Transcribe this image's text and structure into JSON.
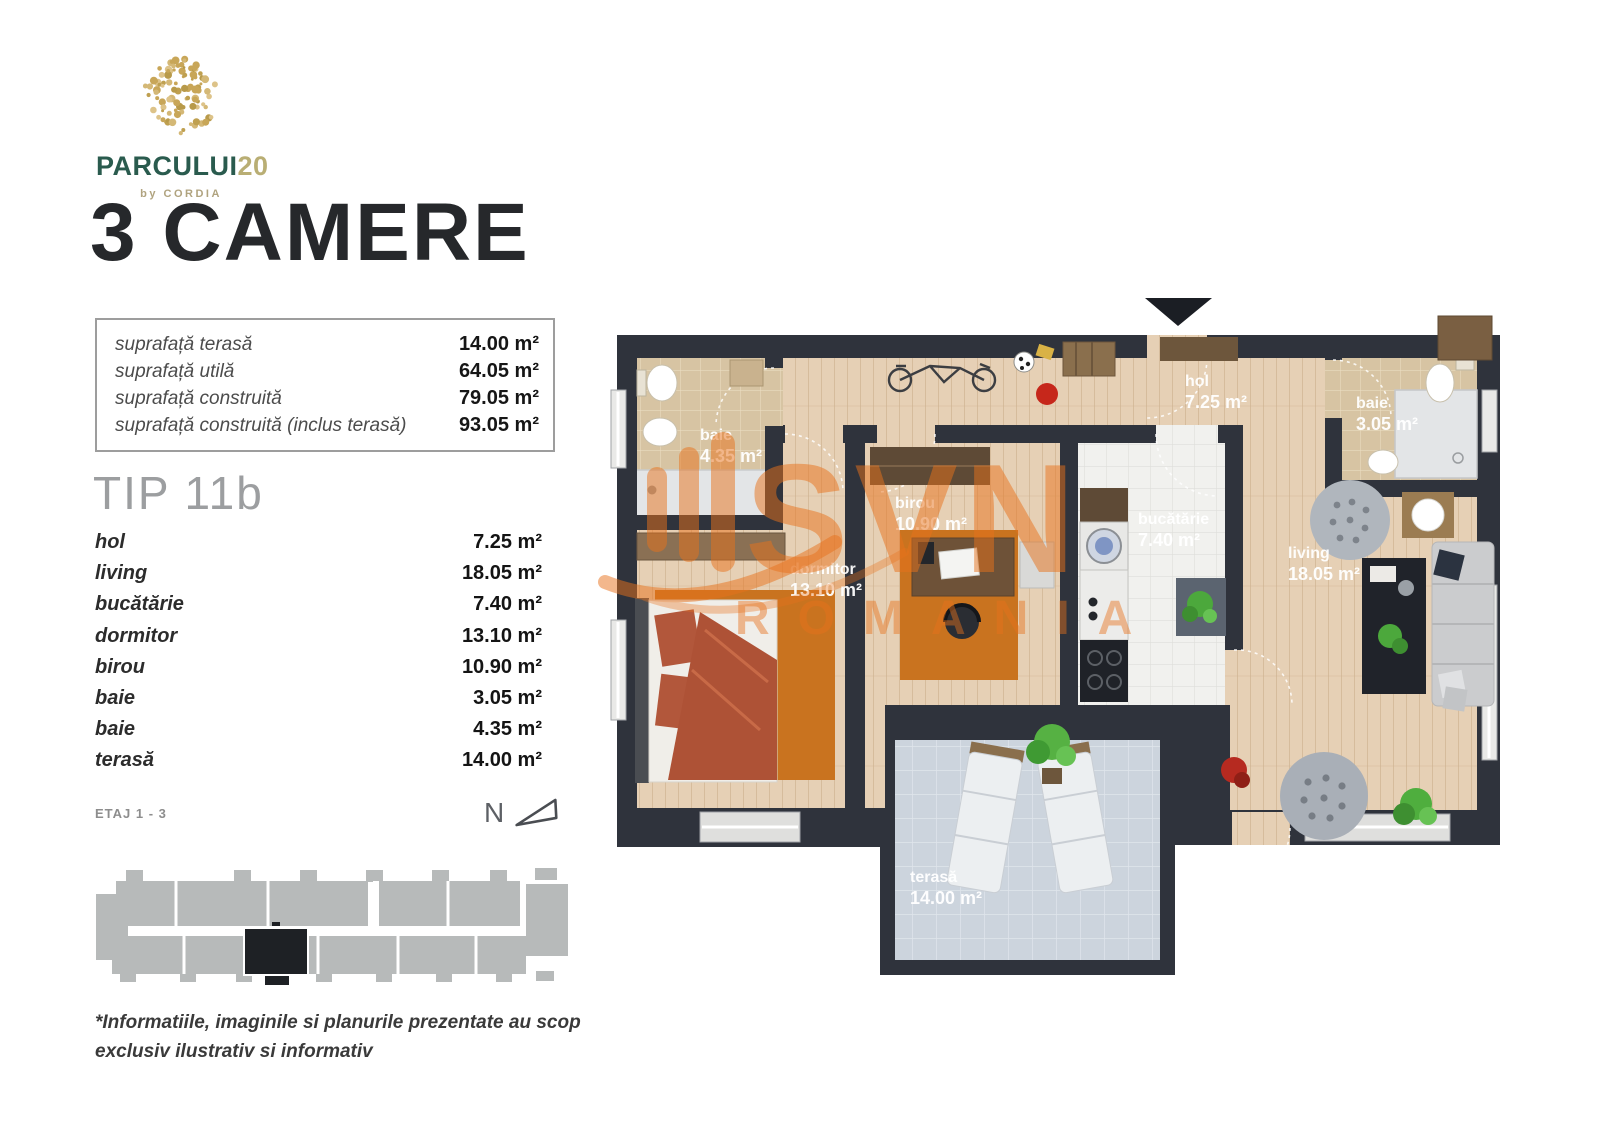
{
  "brand": {
    "name": "PARCULUI",
    "suffix": "20",
    "byline": "by CORDIA"
  },
  "header": {
    "title": "3 CAMERE"
  },
  "summary": {
    "rows": [
      {
        "label": "suprafață terasă",
        "value": "14.00 m²"
      },
      {
        "label": "suprafață utilă",
        "value": "64.05 m²"
      },
      {
        "label": "suprafață construită",
        "value": "79.05 m²"
      },
      {
        "label": "suprafață construită (inclus terasă)",
        "value": "93.05 m²"
      }
    ]
  },
  "unit": {
    "type_label": "TIP 11b",
    "floor_label": "ETAJ 1 - 3",
    "north_label": "N"
  },
  "room_list": [
    {
      "label": "hol",
      "value": "7.25 m²"
    },
    {
      "label": "living",
      "value": "18.05 m²"
    },
    {
      "label": "bucătărie",
      "value": "7.40 m²"
    },
    {
      "label": "dormitor",
      "value": "13.10 m²"
    },
    {
      "label": "birou",
      "value": "10.90 m²"
    },
    {
      "label": "baie",
      "value": "3.05 m²"
    },
    {
      "label": "baie",
      "value": "4.35 m²"
    },
    {
      "label": "terasă",
      "value": "14.00 m²"
    }
  ],
  "floor_plan": {
    "rooms": [
      {
        "name": "baie",
        "area": "4.35 m²"
      },
      {
        "name": "hol",
        "area": "7.25 m²"
      },
      {
        "name": "baie",
        "area": "3.05 m²"
      },
      {
        "name": "birou",
        "area": "10.90 m²"
      },
      {
        "name": "dormitor",
        "area": "13.10 m²"
      },
      {
        "name": "bucătărie",
        "area": "7.40 m²"
      },
      {
        "name": "living",
        "area": "18.05 m²"
      },
      {
        "name": "terasă",
        "area": "14.00 m²"
      }
    ]
  },
  "watermark": {
    "primary": "SVN",
    "secondary": "ROMANIA"
  },
  "disclaimer": {
    "line1": "*Informatiile, imaginile si planurile prezentate au scop",
    "line2": "exclusiv ilustrativ si informativ"
  },
  "colors": {
    "wall": "#2f333c",
    "wood": "#e6d0b5",
    "tan_tile": "#d7c4a3",
    "white_tile": "#f1f1ee",
    "terrace_tile": "#ccd4dd",
    "rug_orange": "#c9731f",
    "watermark_orange": "#e8721c",
    "brand_green": "#2a5b4e",
    "brand_gold": "#b9ae74",
    "footprint_gray": "#b7baba",
    "highlight_black": "#1e2125"
  }
}
